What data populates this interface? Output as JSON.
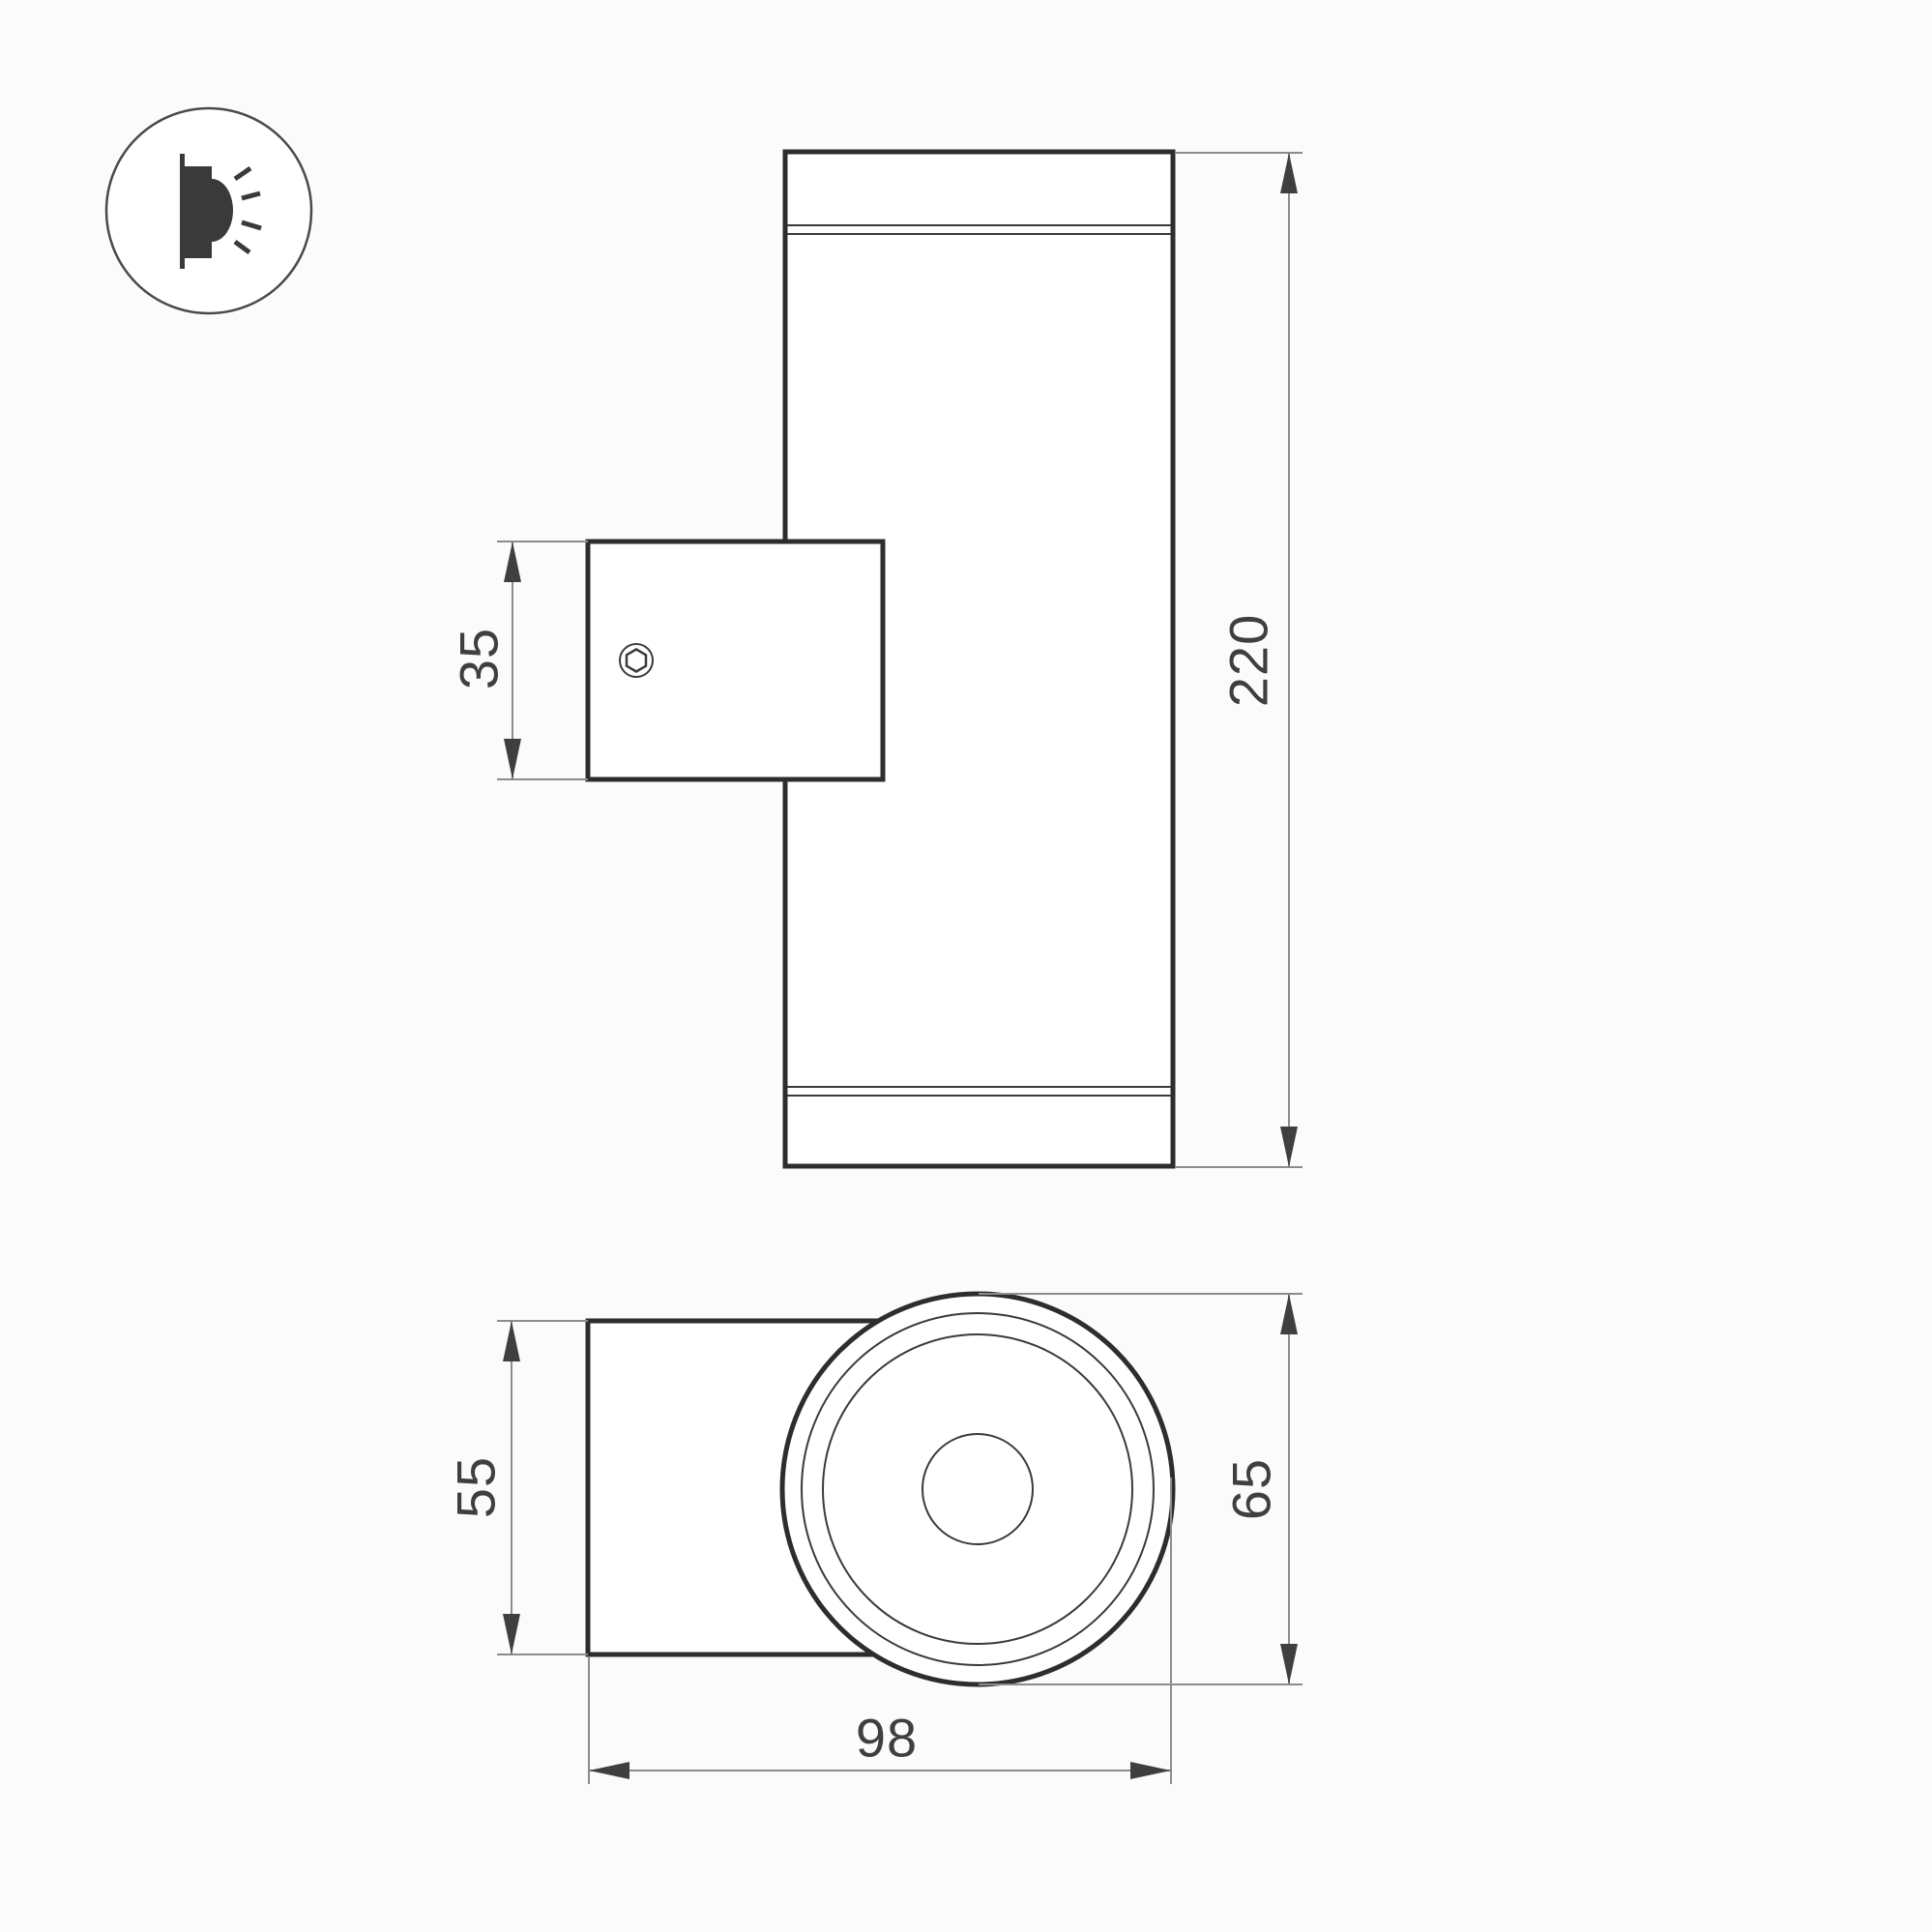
{
  "drawing": {
    "type": "technical-dimension-drawing",
    "subject": "cylindrical up-down wall lamp with mounting bracket",
    "background_color": "#fbfbfb",
    "colors": {
      "object_outline": "#2d2d2d",
      "object_detail": "#3a3a3a",
      "dimension_lines": "#8c8c8c",
      "dimension_text": "#3f3f3f"
    },
    "legend_icon": {
      "name": "wall-mounted-light-side-glow-icon"
    },
    "front_view": {
      "dimensions": {
        "bracket_height": "35",
        "body_height": "220"
      }
    },
    "top_view": {
      "dimensions": {
        "bracket_depth": "55",
        "body_diameter": "65",
        "total_depth": "98"
      }
    }
  }
}
